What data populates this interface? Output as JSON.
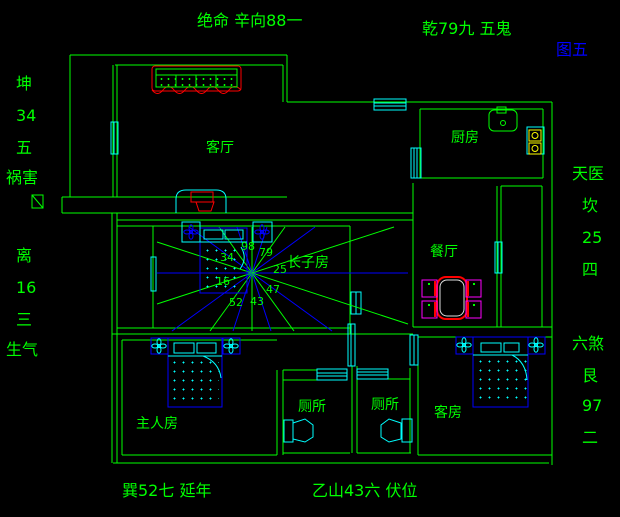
{
  "colors": {
    "wall": "#00ff00",
    "window_fixture": "#00ffff",
    "bed_ray_blue": "#0000ff",
    "highlight_red": "#ff0000",
    "chair_magenta": "#ff00ff",
    "stove_yellow": "#ffff00",
    "figure_label_blue": "#0000ff",
    "background": "#000000"
  },
  "annotations": {
    "top_center": "绝命 辛向88一",
    "top_right": "乾79九 五鬼",
    "figure": "图五",
    "left_upper": [
      "坤",
      "34",
      "五",
      "祸害"
    ],
    "left_lower": [
      "离",
      "16",
      "三",
      "生气"
    ],
    "right_upper": [
      "天医",
      "坎",
      "25",
      "四"
    ],
    "right_lower": [
      "六煞",
      "艮",
      "97",
      "二"
    ],
    "bottom_left": "巽52七 延年",
    "bottom_right": "乙山43六 伏位"
  },
  "rooms": {
    "living": "客厅",
    "kitchen": "厨房",
    "dining": "餐厅",
    "eldest_son": "长子房",
    "master": "主人房",
    "toilet_left": "厕所",
    "toilet_right": "厕所",
    "guest": "客房"
  },
  "compass_numbers": [
    "98",
    "79",
    "25",
    "47",
    "43",
    "52",
    "16",
    "34"
  ]
}
